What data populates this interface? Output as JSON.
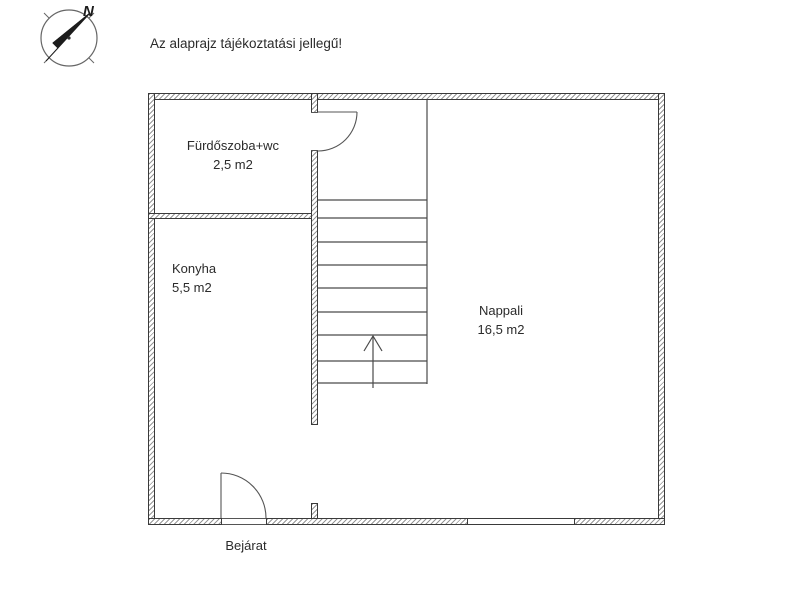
{
  "annotation": {
    "disclaimer": "Az alaprajz tájékoztatási jellegű!"
  },
  "compass": {
    "north_label": "N"
  },
  "floorplan": {
    "rooms": [
      {
        "name": "Fürdőszoba+wc",
        "area": "2,5 m2"
      },
      {
        "name": "Konyha",
        "area": "5,5 m2"
      },
      {
        "name": "Nappali",
        "area": "16,5 m2"
      }
    ],
    "entrance_label": "Bejárat",
    "stairs": {
      "treads": 9,
      "direction": "up"
    },
    "colors": {
      "wall_outline": "#3a3a3a",
      "wall_hatch": "#979797",
      "thin_line": "#4a4a4a",
      "door_line": "#555555",
      "text": "#2b2b2b",
      "background": "#ffffff"
    }
  }
}
